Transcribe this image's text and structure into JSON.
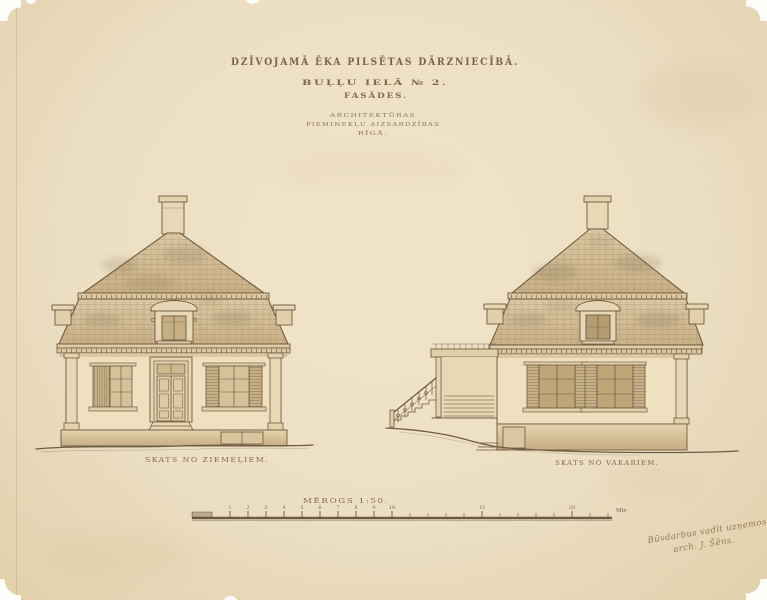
{
  "title_block": {
    "line1": "DZĪVOJAMĀ ĒKA PILSĒTAS DĀRZNIECĪBĀ.",
    "line2": "BUĻĻU IELĀ № 2.",
    "line3": "FASĀDES.",
    "stamp": [
      "ARCHITEKTŪRAS",
      "PIEMINEKĻU AIZSARDZĪBAS",
      "RĪGĀ."
    ]
  },
  "elevations": {
    "left_caption": "SKATS NO ZIEMEĻIEM.",
    "right_caption": "SKATS NO VAKARIEM."
  },
  "scale_bar": {
    "caption": "MĒROGS 1:50.",
    "tick_labels": [
      "1",
      "2",
      "3",
      "4",
      "5",
      "6",
      "7",
      "8",
      "9",
      "10",
      "15",
      "20"
    ],
    "unit_label": "Mtr."
  },
  "annotation": {
    "line1": "Būvdarbus vadīt uzņemos",
    "line2": "arch. J. Šēns."
  },
  "palette": {
    "paper": "#ecdfc2",
    "ink": "#6e5a41",
    "roof_wash": "#d9c49e",
    "roof_shadow": "#a68d66",
    "wall_wash": "#efe0bf",
    "shutter_wash": "#c7b088",
    "glass_wash": "#b9a173",
    "foundation_wash": "#c6ad84"
  }
}
